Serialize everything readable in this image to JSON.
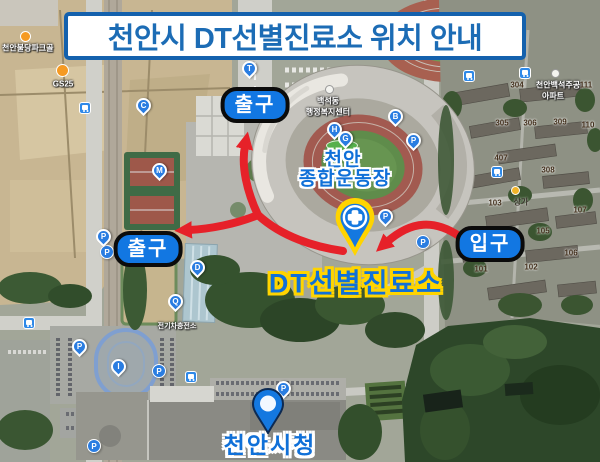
{
  "banner": {
    "title": "천안시 DT선별진료소 위치 안내"
  },
  "callouts": {
    "exit_top": "출구",
    "exit_left": "출구",
    "entrance": "입구",
    "stadium_line1": "천안",
    "stadium_line2": "종합운동장",
    "clinic": "DT선별진료소",
    "city_hall": "천안시청"
  },
  "pins": {
    "t": "T",
    "c": "C",
    "m": "M",
    "b": "B",
    "h": "H",
    "g": "G",
    "d": "D",
    "q": "Q",
    "i": "I",
    "p": "P"
  },
  "pois": {
    "park_golf": "천안불당파크골",
    "gs25": "GS25",
    "dong_office_line1": "백석동",
    "dong_office_line2": "행정복지센터",
    "apartment_line1": "천안백석주공",
    "apartment_line2": "아파트",
    "shops": "상가",
    "ev_charging": "전기차충전소"
  },
  "building_numbers": [
    "304",
    "111",
    "305",
    "306",
    "309",
    "110",
    "407",
    "308",
    "103",
    "107",
    "105",
    "106",
    "101",
    "102"
  ],
  "colors": {
    "banner_text": "#1c6cb5",
    "banner_border": "#1461ad",
    "label_bg": "#1277e2",
    "label_border": "#0b0b0b",
    "arrow_red": "#e62129",
    "clinic_pin_yellow": "#ffd400",
    "pin_blue": "#2a7de1",
    "highlight_text": "#1070d8"
  }
}
